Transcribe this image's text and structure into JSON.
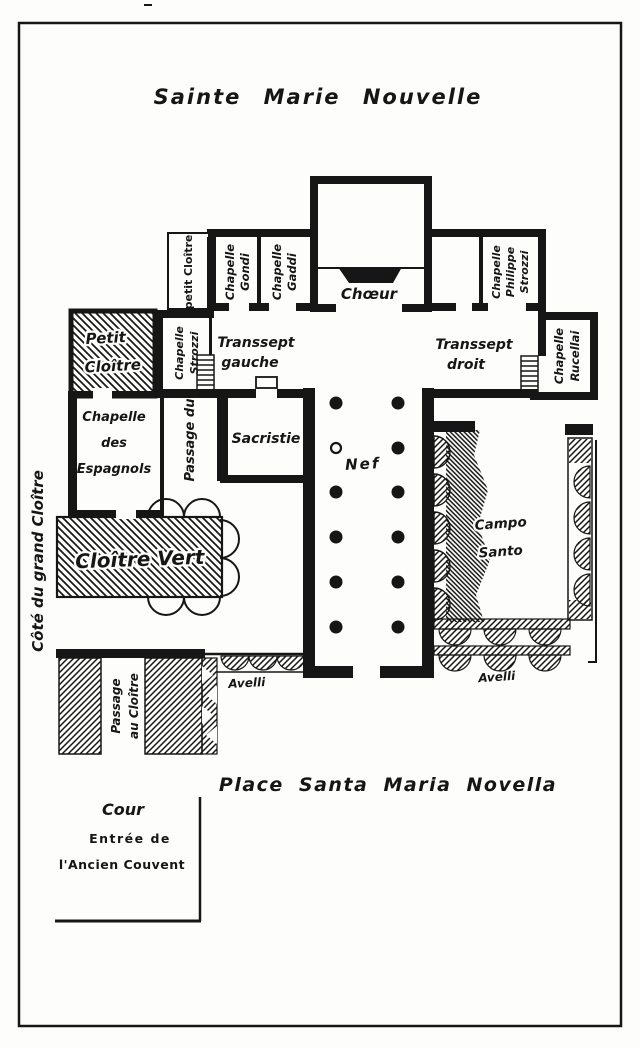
{
  "title": "Sainte Marie Nouvelle",
  "colors": {
    "ink": "#161616",
    "paper": "#fdfdfb"
  },
  "labels": {
    "choeur": "Chœur",
    "petit_cloitre_top": "petit Cloître",
    "chapelle_gondi": [
      "Chapelle",
      "Gondi"
    ],
    "chapelle_gaddi": [
      "Chapelle",
      "Gaddi"
    ],
    "chapelle_philippe_strozzi": [
      "Chapelle",
      "Philippe",
      "Strozzi"
    ],
    "chapelle_strozzi": [
      "Chapelle",
      "Strozzi"
    ],
    "chapelle_rucellai": [
      "Chapelle",
      "Rucellai"
    ],
    "transsept_gauche": [
      "Transsept",
      "gauche"
    ],
    "transsept_droit": [
      "Transsept",
      "droit"
    ],
    "petit_cloitre": [
      "Petit",
      "Cloître"
    ],
    "chapelle_espagnols": [
      "Chapelle",
      "des",
      "Espagnols"
    ],
    "passage_du": "Passage du",
    "sacristie": "Sacristie",
    "nef": "Nef",
    "campo_santo": [
      "Campo",
      "Santo"
    ],
    "cloitre_vert": "Cloître Vert",
    "cote_grand_cloitre": "Côté du grand Cloître",
    "passage_au_cloitre": [
      "Passage",
      "au Cloître"
    ],
    "avelli_left": "Avelli",
    "avelli_right": "Avelli",
    "place": "Place Santa Maria Novella",
    "cour": "Cour",
    "entree": "Entrée de",
    "ancien_couvent": "l'Ancien Couvent"
  }
}
